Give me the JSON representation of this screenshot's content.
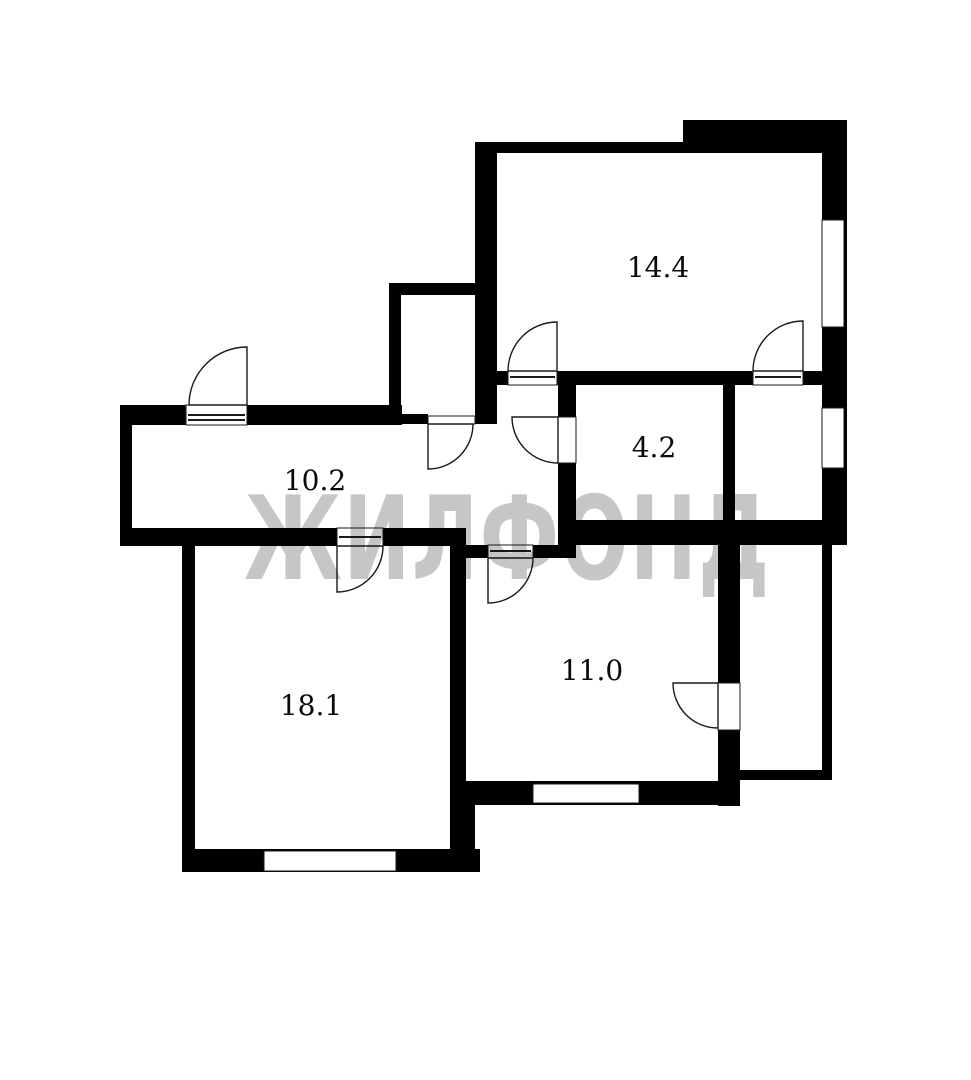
{
  "plan": {
    "watermark_text": "ЖИЛФОНД",
    "rooms": [
      {
        "name": "room-top-right",
        "area_label": "14.4"
      },
      {
        "name": "room-small-right",
        "area_label": "4.2"
      },
      {
        "name": "hallway",
        "area_label": "10.2"
      },
      {
        "name": "room-bottom-left",
        "area_label": "18.1"
      },
      {
        "name": "room-bottom-middle",
        "area_label": "11.0"
      }
    ],
    "colors": {
      "wall": "#000000",
      "background": "#ffffff",
      "watermark": "#c6c6c6",
      "label": "#0a0a0a"
    }
  }
}
